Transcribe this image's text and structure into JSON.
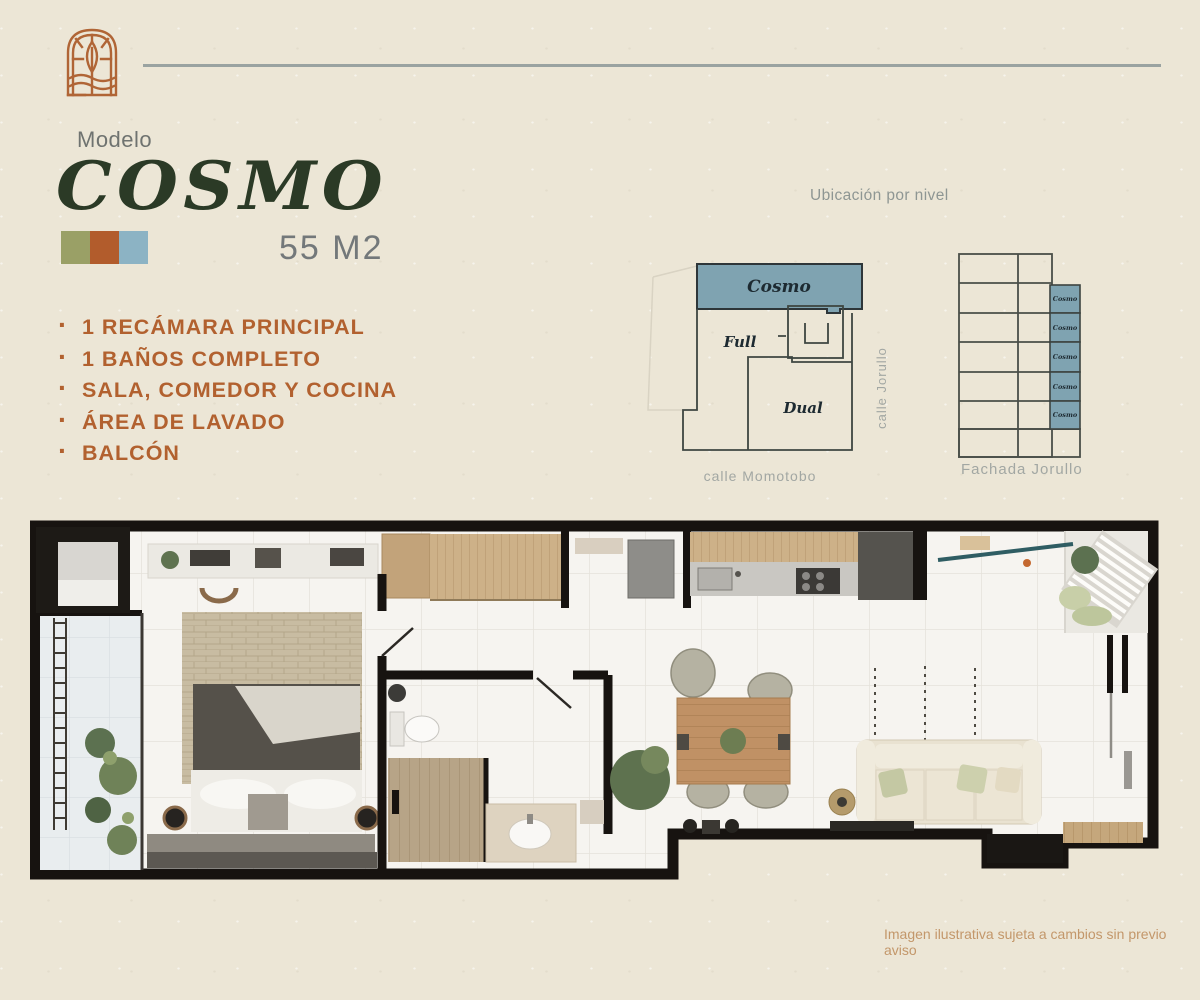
{
  "colors": {
    "paper": "#ece6d6",
    "accent": "#b2612f",
    "title_green": "#2b3a26",
    "muted_gray": "#8e9693",
    "unit_highlight": "#7fa3b1",
    "diagram_line": "#3e4642"
  },
  "model": {
    "label": "Modelo",
    "name": "COSMO",
    "area": "55 M2",
    "swatches": [
      "#9aa066",
      "#b25c2c",
      "#8cb3c4"
    ]
  },
  "features": {
    "bullet": "·",
    "items": [
      "1 RECÁMARA PRINCIPAL",
      "1 BAÑOS COMPLETO",
      "SALA, COMEDOR Y COCINA",
      "ÁREA DE LAVADO",
      "BALCÓN"
    ]
  },
  "level_map": {
    "title": "Ubicación por nivel",
    "unit_cosmo": "Cosmo",
    "unit_full": "Full",
    "unit_dual": "Dual",
    "street_right": "calle Jorullo",
    "street_bottom": "calle Momotobo"
  },
  "facade": {
    "caption": "Fachada Jorullo",
    "unit_label": "Cosmo",
    "floors_highlighted": 5
  },
  "plan": {
    "disclaimer": "Imagen ilustrativa sujeta a cambios sin previo aviso"
  }
}
